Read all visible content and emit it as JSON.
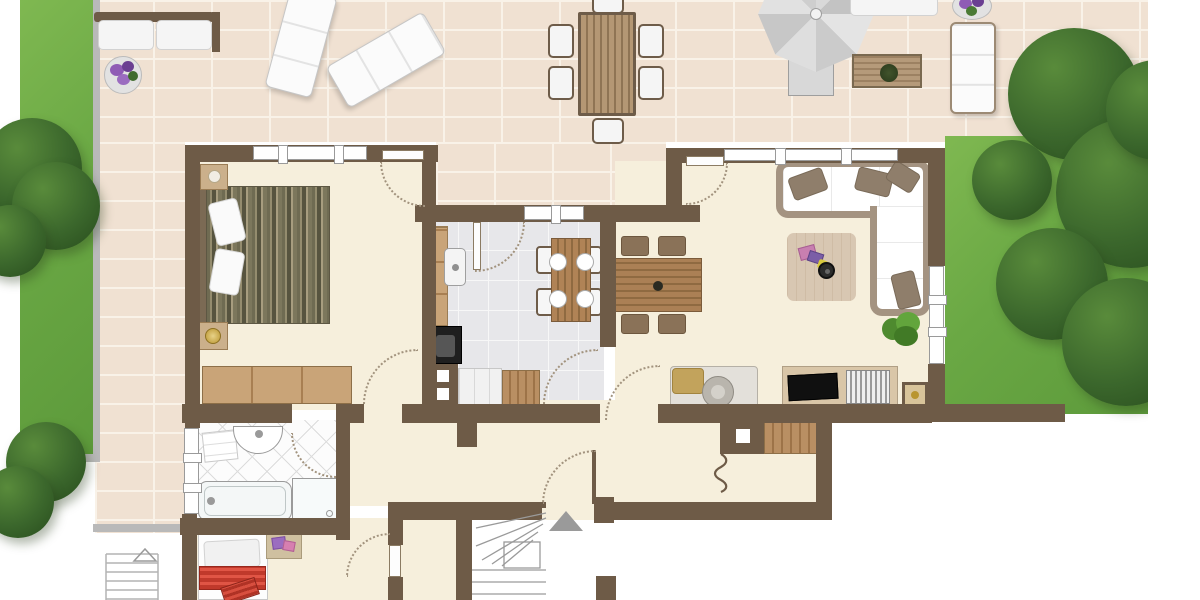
{
  "palette": {
    "wall": "#6e5b47",
    "floor": "#f6efdc",
    "tile": "#f0e1d2",
    "grout": "#f9f2e8",
    "edge": "#b9b9b9",
    "arc": "#a2937e",
    "wood": "#c9a478",
    "grass": "#6aa844",
    "kitchen_tile": "#e7e7ea",
    "sofa_frame": "#a49381",
    "accent_red": "#c0392b",
    "umbrella_gray": "#d2d2d2"
  },
  "plan": {
    "view": "top-down-floor-plan",
    "outdoor": {
      "left_lawn": {
        "element": "lawn-strip",
        "trees": 2,
        "edging": "gray-border"
      },
      "right_garden": {
        "element": "lawn",
        "trees": 1,
        "enclosed_by": "garden-wall"
      },
      "patio_furniture": [
        "garden-bench",
        "flower-pot",
        "sun-lounger-a",
        "sun-lounger-b",
        "outdoor-dining-table",
        "six-outdoor-chairs",
        "parasol",
        "parasol-table",
        "slatted-coffee-table",
        "outdoor-sofa",
        "sun-lounger-c",
        "flower-pot-2"
      ]
    },
    "rooms": [
      {
        "name": "bedroom",
        "furniture": [
          "double-bed",
          "two-pillows",
          "nightstand",
          "lamp-table",
          "wardrobe"
        ],
        "windows": 1,
        "doors": 2
      },
      {
        "name": "kitchen",
        "furniture": [
          "counter-run",
          "sink",
          "stove",
          "lower-cabinet",
          "island-block",
          "breakfast-table",
          "four-plates"
        ],
        "windows": 1,
        "doors": 2
      },
      {
        "name": "living-dining-room",
        "furniture": [
          "dining-table",
          "four-dining-chairs",
          "corner-sofa",
          "three-sofa-pillows",
          "rug",
          "side-table",
          "toys",
          "plant",
          "tv-sideboard",
          "tv",
          "media-rack",
          "desk-with-chair",
          "floor-unit"
        ],
        "windows": 2,
        "doors": 2
      },
      {
        "name": "bathroom",
        "furniture": [
          "washbasin",
          "towel",
          "bathtub",
          "shower"
        ],
        "windows": 1,
        "doors": 1
      },
      {
        "name": "kids-bedroom",
        "furniture": [
          "single-bed",
          "red-striped-blanket",
          "red-cushion",
          "play-mat"
        ],
        "doors": 1
      },
      {
        "name": "hallway",
        "features": [
          "entry-door",
          "chimney-with-flue",
          "smoke-squiggle-symbol",
          "wood-shelf"
        ]
      },
      {
        "name": "stairwell",
        "features": [
          "winder-staircase",
          "landing",
          "direction-arrow-up"
        ]
      }
    ],
    "symbols": {
      "stair_direction_arrow": "filled-triangle-up",
      "exterior_stairs_arrow": "outlined-triangle-up",
      "chimney_flue": "white-square-in-wall",
      "door_swings": "dotted-quarter-arcs"
    }
  }
}
